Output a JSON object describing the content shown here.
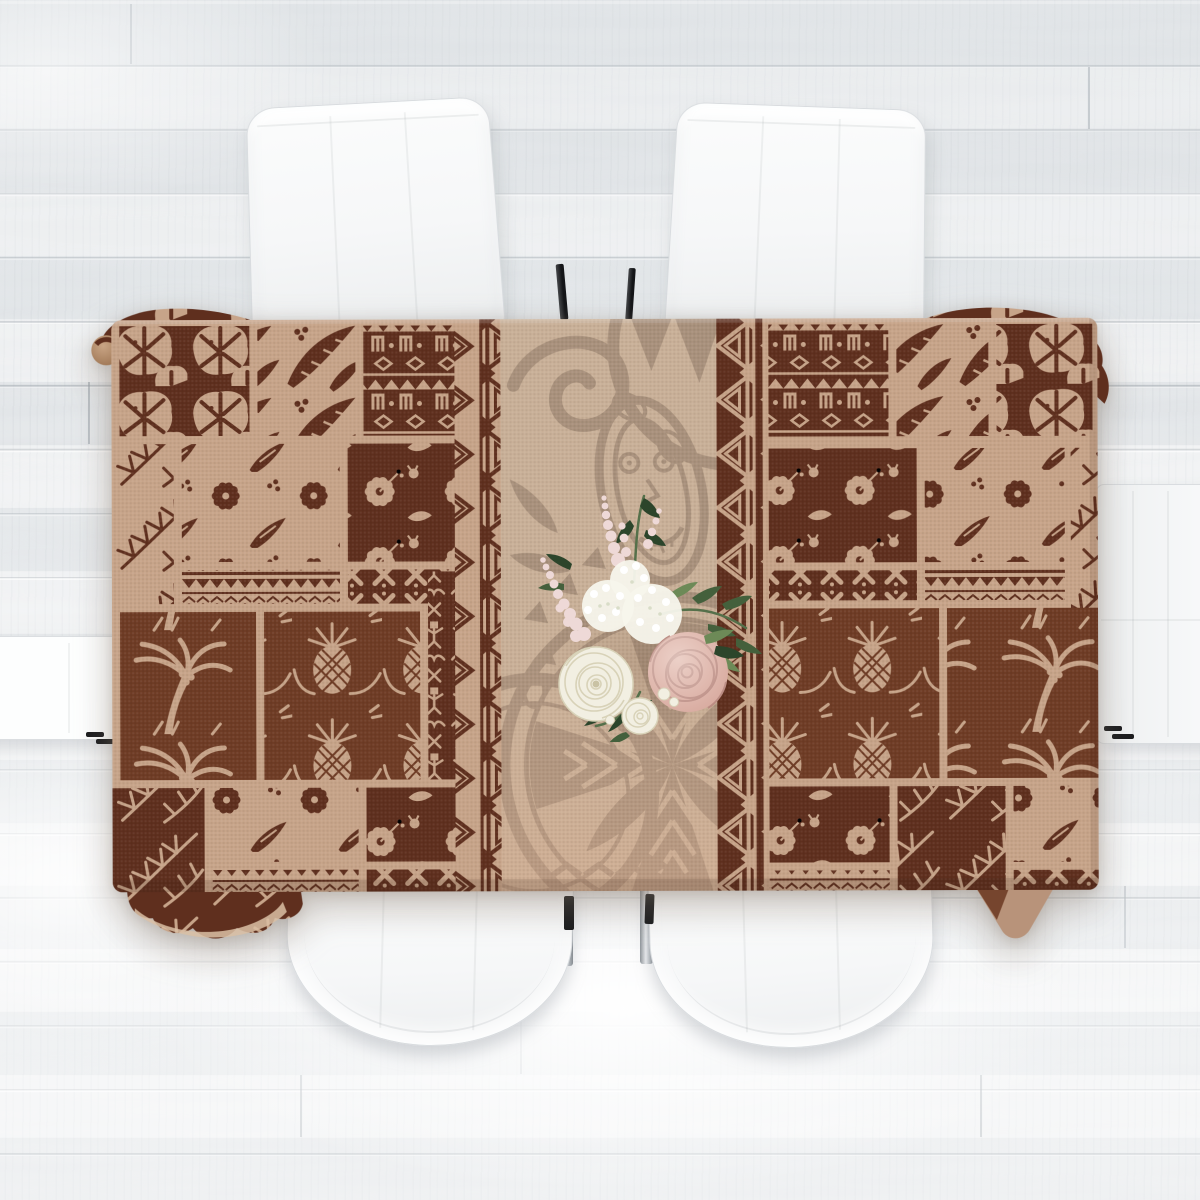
{
  "scene": {
    "description": "Top-down product photo: a rectangular Hawaiian tapa patchwork tablecloth in dark brown and tan covering a dining table, a small bouquet of white and blush roses with greenery at its center, six white upholstered chairs around the table, all on a whitewashed wood plank floor",
    "objects": {
      "tablecloth": "tropical tapa patchwork tablecloth",
      "bouquet": "white and blush rose bouquet",
      "chairs": "white upholstered dining chairs",
      "floor": "whitewashed wood plank floor",
      "table_legs": "chrome table legs"
    },
    "chair_count": 6,
    "tablecloth_motifs": [
      "monstera-leaves",
      "hibiscus-flowers",
      "pineapples",
      "palm-trees",
      "fern-fronds",
      "banana-leaves",
      "tapa-glyph-bands",
      "triangle-zigzag-borders",
      "polynesian-tattoo-medallion",
      "tiki-mask",
      "koru-spiral",
      "chevron-rows"
    ]
  },
  "colors": {
    "floor_base": "#eceef0",
    "floor_seam": "#c7ccd0",
    "chair_white": "#fbfcfc",
    "chair_shade": "#eceeef",
    "chrome_light": "#eef0f2",
    "chrome_dark": "#8e9499",
    "leg_black": "#1b1c1e",
    "cloth_dark": "#5f2f1e",
    "cloth_dark2": "#6f3c25",
    "cloth_tan": "#c7a489",
    "cloth_tan_light": "#dac0a5",
    "band_bg": "#c9b098",
    "band_motif": "#8c7663",
    "underside": "#b8937a",
    "rose_white": "#f2efe2",
    "rose_white_shade": "#d8d2b8",
    "rose_pink": "#d9aca1",
    "rose_pink_shade": "#bb8c83",
    "lace_white": "#f7f5ec",
    "astilbe_pink": "#eed9d7",
    "leaf_green": "#44603c",
    "leaf_green_dark": "#2c452b",
    "leaf_green_light": "#6d8a57",
    "stem_green": "#55704a"
  }
}
